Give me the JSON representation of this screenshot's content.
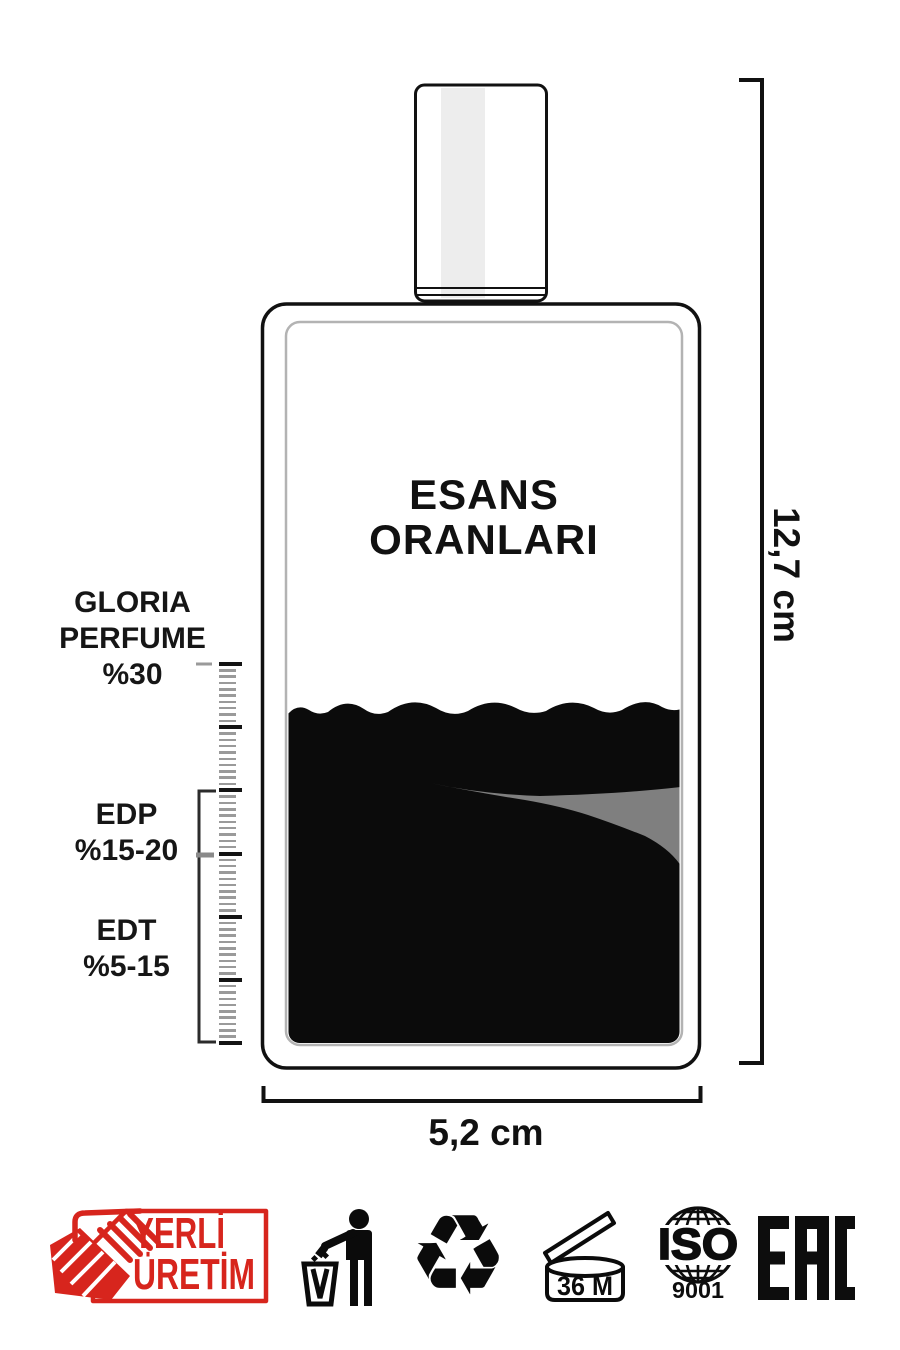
{
  "bottle": {
    "title_line1": "ESANS",
    "title_line2": "ORANLARI"
  },
  "ratio_scale": {
    "gloria_label": {
      "line1": "GLORIA",
      "line2": "PERFUME",
      "line3": "%30"
    },
    "edp_label": {
      "line1": "EDP",
      "line2": "%15-20"
    },
    "edt_label": {
      "line1": "EDT",
      "line2": "%5-15"
    }
  },
  "dimensions": {
    "height_label": "12,7 cm",
    "width_label": "5,2 cm"
  },
  "footer_badges": {
    "yerli_uretim": {
      "line1": "YERLİ",
      "line2": "ÜRETİM"
    },
    "recycle_symbol": "♻",
    "period_after_opening": "36 M",
    "iso_top": "ISO",
    "iso_bottom": "9001",
    "eac": "EAC"
  },
  "colors": {
    "accent_red": "#d7251d",
    "liquid_black": "#0b0b0b",
    "streak_gray": "#7f7f7f",
    "inner_outline_gray": "#b3b3b3"
  }
}
